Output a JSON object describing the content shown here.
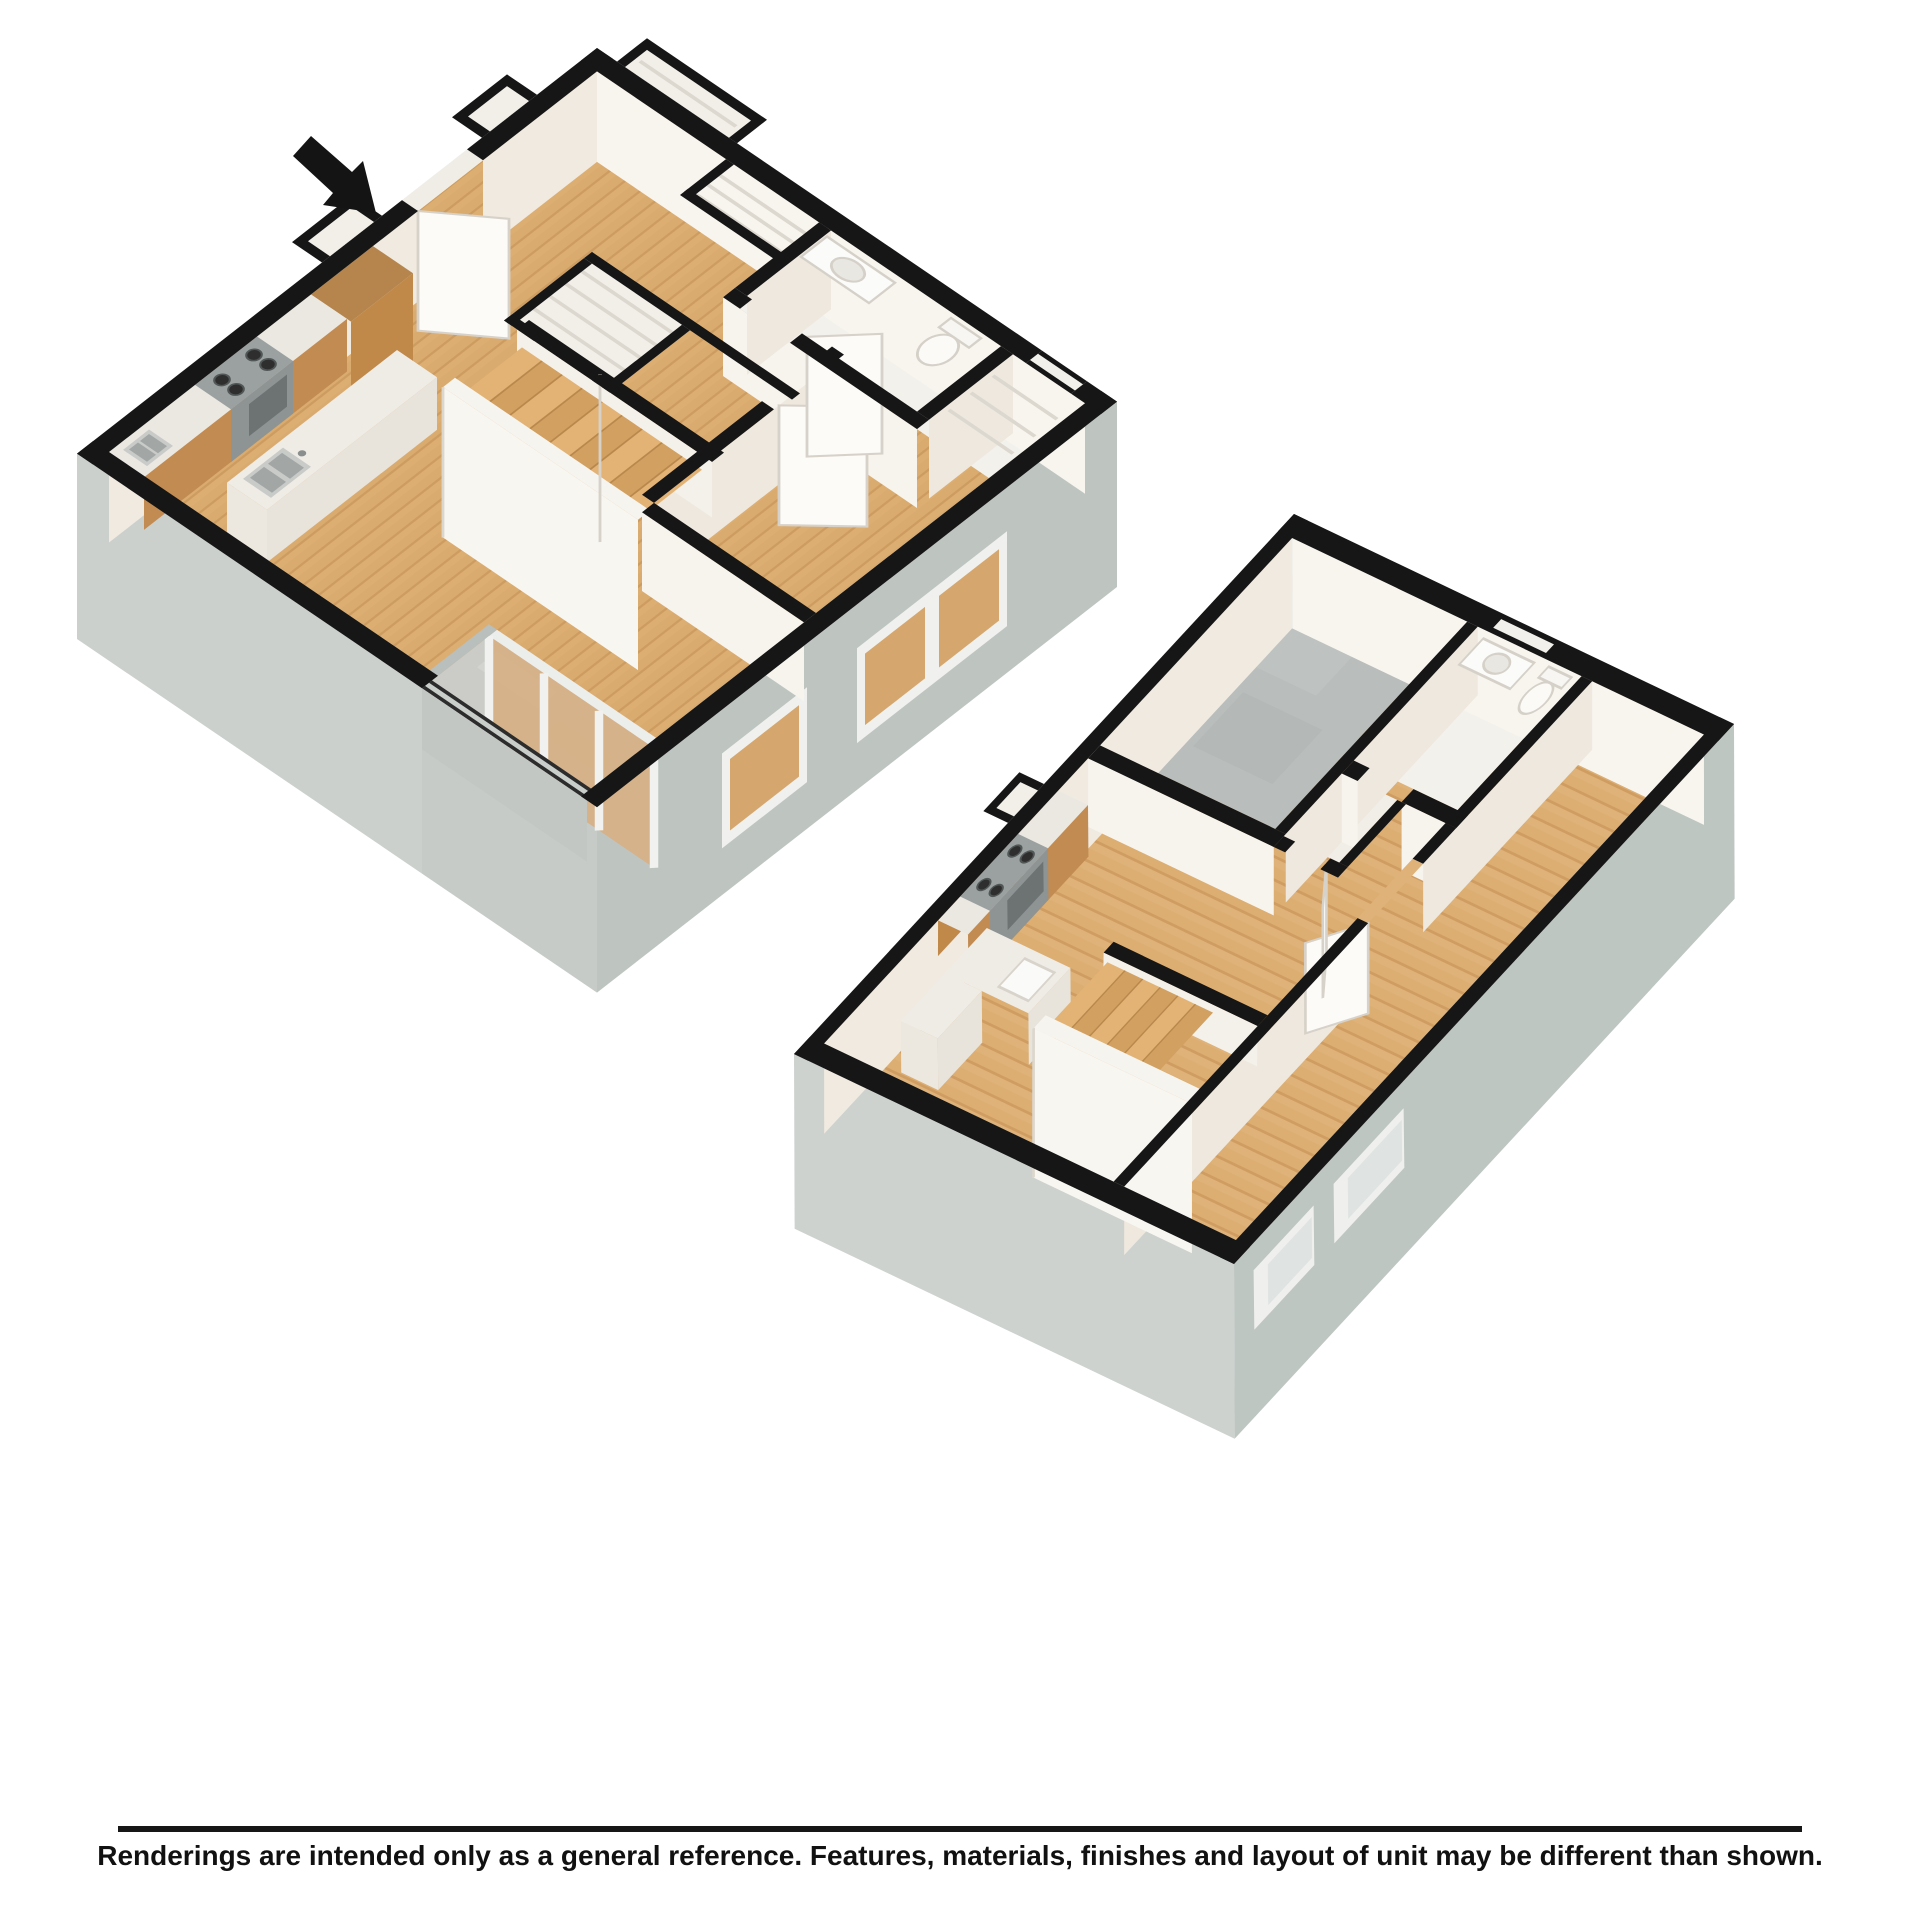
{
  "disclaimer": {
    "text": "Renderings are intended only as a general reference. Features, materials, finishes and layout of unit may be different than shown."
  },
  "icons": {
    "entry_arrow": "➘"
  },
  "colors": {
    "background": "#ffffff",
    "wall_cut_black": "#161616",
    "wood_floor": "#dcae72",
    "wood_plank_line": "#cd9c60",
    "cabinet_wood": "#c28b52",
    "counter_white": "#ebe8e2",
    "interior_wall_bright": "#f8f5ef",
    "interior_wall_shaded": "#eee8df",
    "stair_wall_white": "#f8f6f1",
    "facade_light_gray": "#cdd2cf",
    "facade_shaded_gray": "#bec6c2",
    "balcony_concrete": "#cbccc8",
    "utility_floor_gray": "#b9bdbb",
    "stainless_steel": "#9ba1a1",
    "window_glazing_tan": "#d5a76e",
    "text": "#111111"
  }
}
